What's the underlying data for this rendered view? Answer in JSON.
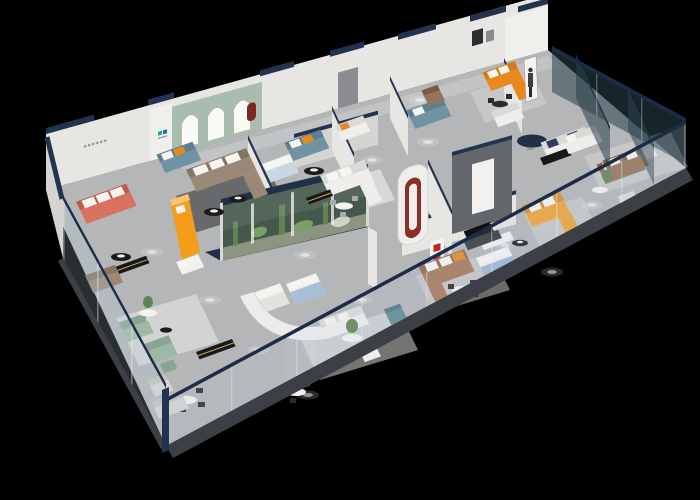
{
  "scene": {
    "type": "3d-isometric-floor-plan-render",
    "subject": "Furniture showroom interior cutaway viewed from above on a black background",
    "camera": "high-angle isometric from the lower-right",
    "background": "#000000"
  },
  "palette": {
    "floor": "#b4b6b8",
    "walkway": "#3c4046",
    "wall": "#e8e6e2",
    "wall_bright": "#f1efeb",
    "wall_shadow": "#d6d4d0",
    "cap_navy": "#223350",
    "rail_navy": "#1d2c46",
    "sage_wall": "#a9bcae",
    "arch_glow": "#fbfaf6",
    "glass_front": "rgba(187,208,222,0.16)",
    "glass_left": "rgba(187,208,222,0.22)",
    "glass_dark": "rgba(42,66,74,0.55)",
    "terr_roof": "#1f3048",
    "terr_bg": "#46584c",
    "plant": "#5f8454",
    "plant_light": "#7aa068",
    "sand": "#8d9480",
    "coral": "#d9715f",
    "coral_dark": "#c05b4b",
    "taupe": "#9b8877",
    "taupe_dark": "#877564",
    "teal_sofa": "#6f93a2",
    "teal_sofa_dark": "#5c8090",
    "orange": "#e8891f",
    "orange_dark": "#d47a18",
    "amber": "#f0a335",
    "amber_dark": "#d88e26",
    "counter_orange": "#f59c1a",
    "counter_orange_light": "#ffc36a",
    "brown": "#97735c",
    "caramel": "#a9765a",
    "caramel_dark": "#93644b",
    "sage": "#9fb8a6",
    "sage_dark": "#8aa492",
    "gray_sofa": "#d6d5d1",
    "white_furn": "#efeeec",
    "white_furn_dark": "#dcdad6",
    "bed_blue": "#a9bfd8",
    "bed_pale": "#c9d6e4",
    "bed_blue2": "#9fb4d4",
    "dark_console": "#17181a",
    "gold": "#c9a55a",
    "black_table": "#1b1b1d",
    "dark_wall": "#63666a",
    "red_slide": "#8a2f2a",
    "red_sign": "#c0271f",
    "teal_ottoman": "#5f8a96",
    "navy_cushion": "#2c3e5c",
    "logo_teal": "#18aaa2",
    "logo_blue": "#1f6db5"
  },
  "areas": [
    {
      "id": "coral-lounge",
      "label": "Coral sofa lounge with wall lettering",
      "items": [
        "coral 3-seat sofa",
        "black round coffee table"
      ]
    },
    {
      "id": "arched-gallery",
      "label": "Sage wall with three backlit arches",
      "items": [
        "teal mini brand logo",
        "orange curved bench",
        "taupe L-sectional",
        "dark gray rug",
        "red wall niche"
      ]
    },
    {
      "id": "terrarium",
      "label": "Indoor landscape glass vitrine",
      "items": [
        "cacti",
        "plants",
        "white slats",
        "navy roof band"
      ]
    },
    {
      "id": "bed-gallery",
      "label": "Bed displays behind curved white partition",
      "items": [
        "white bed",
        "blue bed",
        "pale blue bed"
      ]
    },
    {
      "id": "central-lounge",
      "label": "White sectional lounge with dining table and black console"
    },
    {
      "id": "red-sculpture",
      "label": "White pillar with red ribbon-slide inset"
    },
    {
      "id": "feature-wall",
      "label": "Dark feature wall with white door panel and navy round table"
    },
    {
      "id": "amber-lounge",
      "label": "Amber L-sofa lounge with black coffee table"
    },
    {
      "id": "caramel-lounge",
      "label": "Caramel leather sectional with dining set and red seal signage"
    },
    {
      "id": "blue-bedroom",
      "label": "Blue bed with white wardrobe and TV cabinet"
    },
    {
      "id": "corner-room",
      "label": "Orange corner sofa room with promo standee figure and picture frames"
    },
    {
      "id": "right-wing",
      "label": "Dark-glass partitioned rooms",
      "items": [
        "white sofa",
        "brown leather sofas",
        "white armchairs",
        "plant",
        "black shelf"
      ]
    },
    {
      "id": "sage-lounge",
      "label": "Sage green modular sofas with flower table and gray armchair"
    },
    {
      "id": "dining-areas",
      "label": "White dining tables with chairs",
      "count": 5
    },
    {
      "id": "glazing",
      "label": "Perimeter glass balustrade with navy top rails and mullions"
    }
  ],
  "signage": [
    {
      "name": "brand-logo-mini",
      "legible": false
    },
    {
      "name": "coral-room-lettering",
      "legible": false
    },
    {
      "name": "red-seal-sign",
      "legible": false
    }
  ],
  "lighting": {
    "style": "recessed ceiling spotlights as glow pools on floor",
    "pools": 16
  }
}
